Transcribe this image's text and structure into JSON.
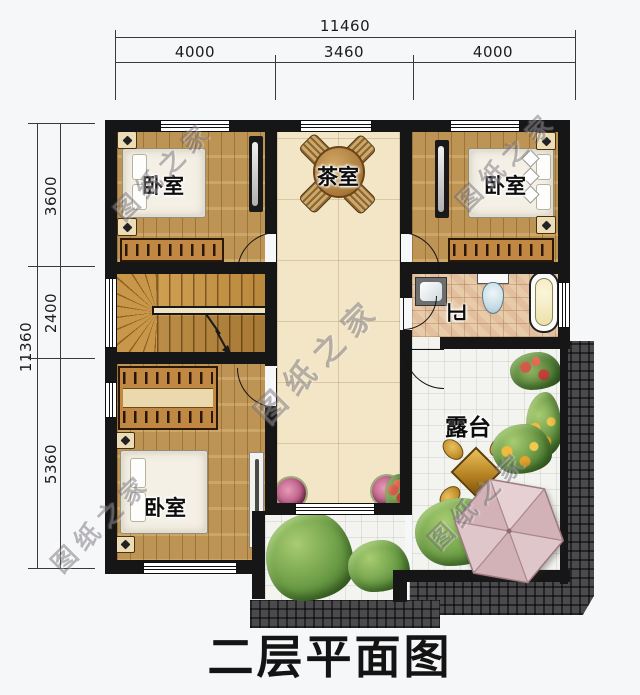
{
  "plan": {
    "title": "二层平面图",
    "watermark": "图纸之家"
  },
  "dimensions": {
    "top": {
      "total": "11460",
      "segments": [
        "4000",
        "3460",
        "4000"
      ]
    },
    "left": {
      "total": "11360",
      "segments": [
        "3600",
        "2400",
        "5360"
      ]
    }
  },
  "rooms": {
    "bedroom_top_left": "卧室",
    "bedroom_top_right": "卧室",
    "bedroom_bottom_left": "卧室",
    "tea_room": "茶室",
    "bathroom": "卫",
    "terrace": "露台"
  },
  "colors": {
    "wall": "#161616",
    "wood_floor": "#c79c58",
    "hall_tile": "#f3e6c7",
    "bath_tile": "#e8ccaa",
    "terrace_tile": "#f3f3f0",
    "paving": "#4b4b4e",
    "umbrella": "#dcc2c6"
  }
}
